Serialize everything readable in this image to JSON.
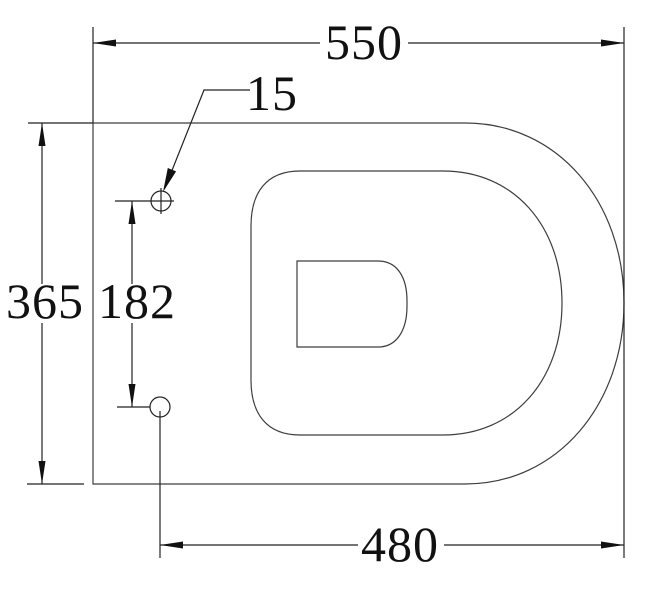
{
  "drawing": {
    "type": "technical-dimension-drawing",
    "subject": "toilet-pan-top-view",
    "units": "mm",
    "dimensions": {
      "overall_width": "550",
      "fixing_hole_diameter": "15",
      "overall_depth": "365",
      "fixing_hole_spacing": "182",
      "hole_to_front_width": "480"
    },
    "colors": {
      "background": "#ffffff",
      "outline": "#3d3d3d",
      "dimension_line": "#222222",
      "text": "#111111"
    }
  }
}
